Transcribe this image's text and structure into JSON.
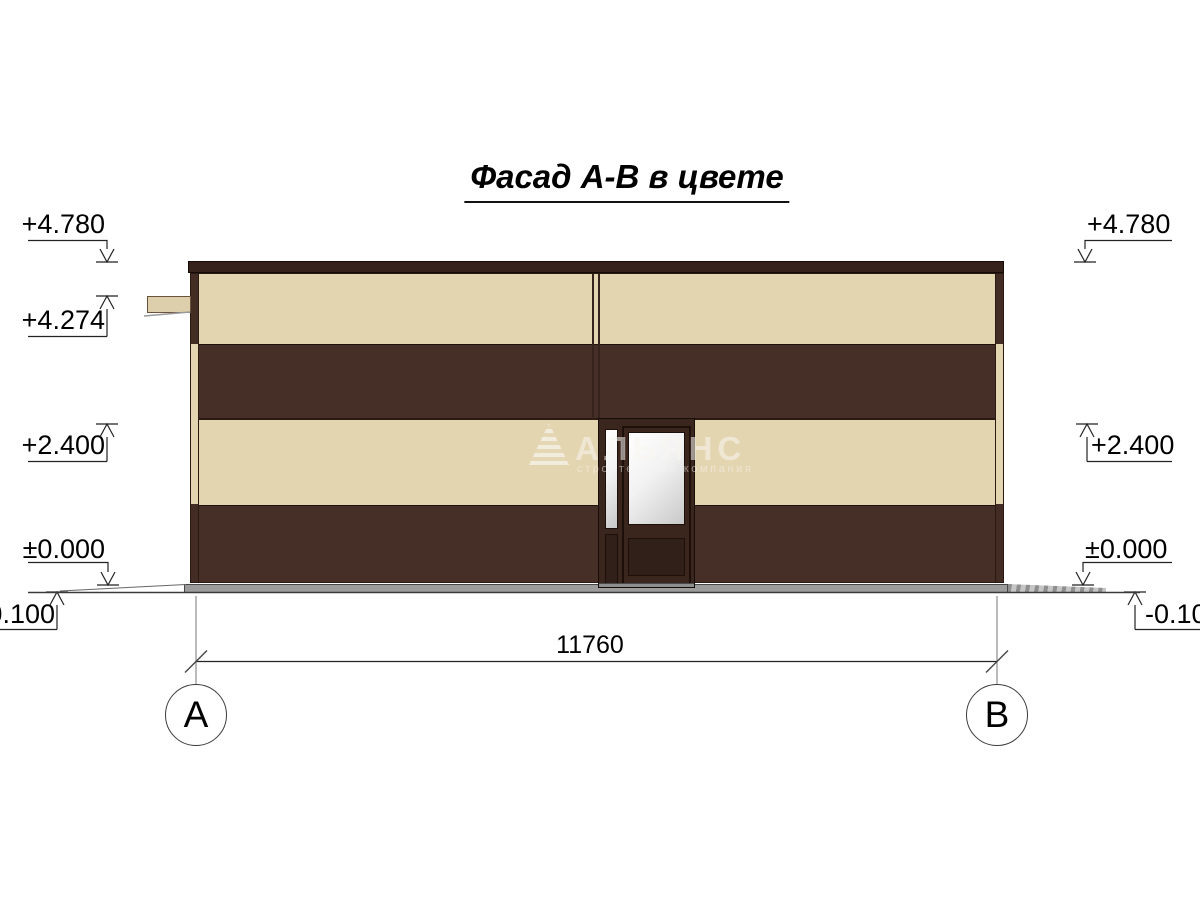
{
  "title": {
    "text": "Фасад А-В в цвете"
  },
  "watermark": {
    "company": "АЛЬЯНС",
    "tagline": "строительная компания",
    "logo": "striped-pyramid-logo"
  },
  "elevation_markers": {
    "left": [
      {
        "label": "+4.780"
      },
      {
        "label": "+4.274"
      },
      {
        "label": "+2.400"
      },
      {
        "label": "±0.000"
      },
      {
        "label": "-0.100"
      }
    ],
    "right": [
      {
        "label": "+4.780"
      },
      {
        "label": "+2.400"
      },
      {
        "label": "±0.000"
      },
      {
        "label": "-0.100"
      }
    ]
  },
  "dimension": {
    "width_mm": "11760"
  },
  "axes": [
    {
      "label": "А"
    },
    {
      "label": "В"
    }
  ],
  "colors": {
    "facade_dark_brown": "#452f27",
    "facade_beige": "#e4d5b1",
    "parapet_brown": "#36221a",
    "plinth_gray": "#9c9c9c",
    "glass_light": "#f5f5f5",
    "annotation_line": "#222222"
  }
}
